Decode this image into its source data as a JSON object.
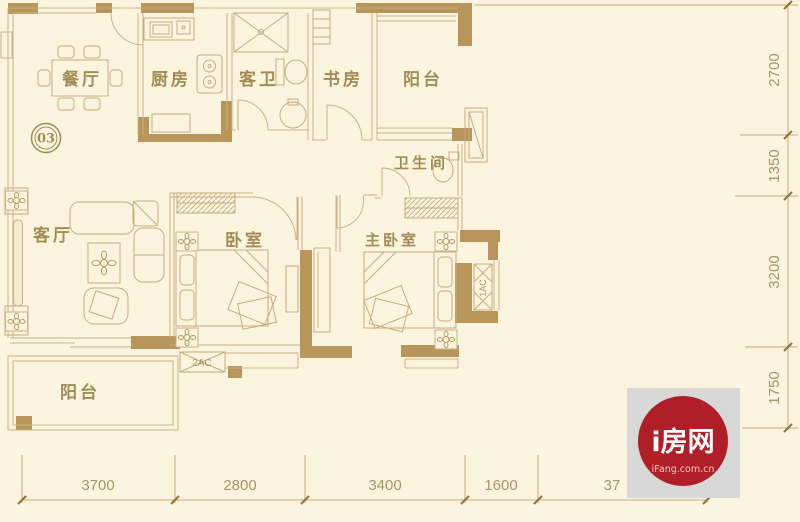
{
  "meta": {
    "type": "apartment-floor-plan",
    "unit_number": "03"
  },
  "rooms": [
    {
      "id": "dining-room",
      "label": "餐厅"
    },
    {
      "id": "kitchen",
      "label": "厨房"
    },
    {
      "id": "guest-bathroom",
      "label": "客卫"
    },
    {
      "id": "study",
      "label": "书房"
    },
    {
      "id": "balcony-top",
      "label": "阳台"
    },
    {
      "id": "bathroom",
      "label": "卫生间"
    },
    {
      "id": "living-room",
      "label": "客厅"
    },
    {
      "id": "bedroom",
      "label": "卧室"
    },
    {
      "id": "master-bedroom",
      "label": "主卧室"
    },
    {
      "id": "balcony-bottom",
      "label": "阳台"
    }
  ],
  "ac_units": [
    {
      "id": "ac-2",
      "label": "2AC"
    },
    {
      "id": "ac-1",
      "label": "1AC"
    }
  ],
  "dimensions": {
    "right": [
      "2700",
      "1350",
      "3200",
      "1750"
    ],
    "bottom": [
      "3700",
      "2800",
      "3400",
      "1600",
      "37"
    ]
  },
  "logo": {
    "title": "i房网",
    "subtitle": "iFang.com.cn"
  },
  "colors": {
    "background": "#fbf4df",
    "wall": "#b8955a",
    "line": "#c9b387",
    "label_text": "#a28c55",
    "dim_text": "#a9946a",
    "logo_red": "#b01e27",
    "logo_bg": "#d8d8d8"
  }
}
